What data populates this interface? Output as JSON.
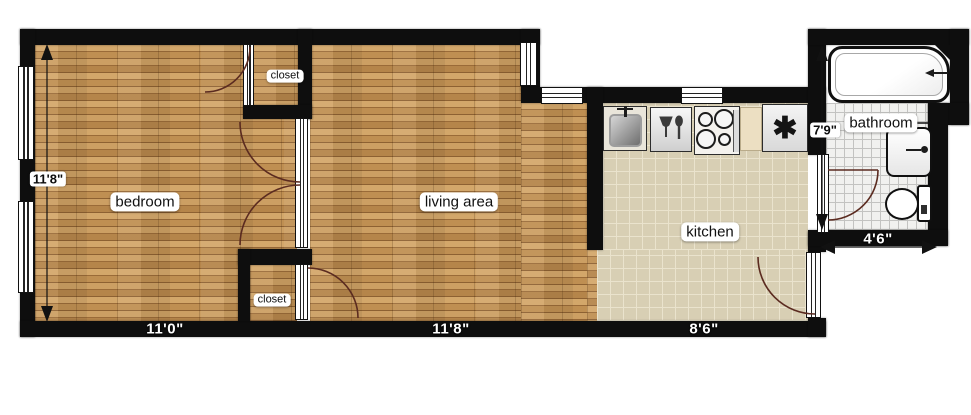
{
  "plan_title": "apartment floor plan",
  "rooms": {
    "bedroom": {
      "label": "bedroom"
    },
    "living": {
      "label": "living area"
    },
    "kitchen": {
      "label": "kitchen"
    },
    "bathroom": {
      "label": "bathroom"
    },
    "closet_top": {
      "label": "closet"
    },
    "closet_bottom": {
      "label": "closet"
    }
  },
  "dimensions": {
    "bedroom_height": {
      "label": "11'8\"",
      "orientation": "vertical"
    },
    "bedroom_width": {
      "label": "11'0\"",
      "orientation": "horizontal"
    },
    "living_width": {
      "label": "11'8\"",
      "orientation": "horizontal"
    },
    "kitchen_width": {
      "label": "8'6\"",
      "orientation": "horizontal"
    },
    "bathroom_height": {
      "label": "7'9\"",
      "orientation": "vertical"
    },
    "bathroom_width": {
      "label": "4'6\"",
      "orientation": "horizontal"
    }
  },
  "fixtures": {
    "bathtub": "bathtub",
    "bathroom_sink": "sink",
    "toilet": "toilet",
    "kitchen_sink": "kitchen sink",
    "dishwasher": "dishwasher",
    "stove": "stove",
    "refrigerator_symbol": "✱"
  },
  "colors": {
    "wall": "#0e0e0e",
    "wood_floor": "#c49659",
    "kitchen_tile": "#d8cfb4",
    "bathroom_tile": "#f1f1ef",
    "door_arc": "#5b2b20",
    "label_bg": "#ffffff"
  }
}
